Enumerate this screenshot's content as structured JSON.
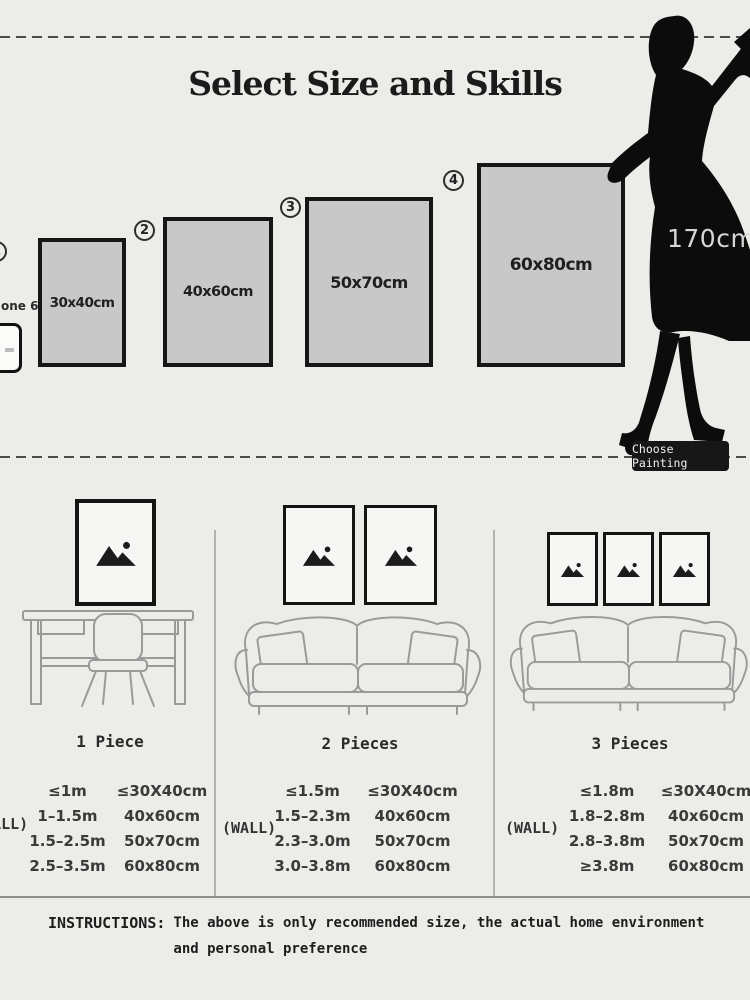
{
  "title": "Select Size and Skills",
  "sizes": {
    "items": [
      {
        "num": "1",
        "label": "30x40cm"
      },
      {
        "num": "2",
        "label": "40x60cm"
      },
      {
        "num": "3",
        "label": "50x70cm"
      },
      {
        "num": "4",
        "label": "60x80cm"
      }
    ],
    "phone_label": "one 6",
    "height_label": "170cm",
    "choose_button": "Choose Painting"
  },
  "scenes": [
    {
      "label": "1 Piece"
    },
    {
      "label": "2 Pieces"
    },
    {
      "label": "3 Pieces"
    }
  ],
  "tables": [
    {
      "wall_label": "(WALL)",
      "rows": [
        [
          "≤1m",
          "≤30X40cm"
        ],
        [
          "1–1.5m",
          "40x60cm"
        ],
        [
          "1.5–2.5m",
          "50x70cm"
        ],
        [
          "2.5–3.5m",
          "60x80cm"
        ]
      ]
    },
    {
      "wall_label": "(WALL)",
      "rows": [
        [
          "≤1.5m",
          "≤30X40cm"
        ],
        [
          "1.5–2.3m",
          "40x60cm"
        ],
        [
          "2.3–3.0m",
          "50x70cm"
        ],
        [
          "3.0–3.8m",
          "60x80cm"
        ]
      ]
    },
    {
      "wall_label": "(WALL)",
      "rows": [
        [
          "≤1.8m",
          "≤30X40cm"
        ],
        [
          "1.8–2.8m",
          "40x60cm"
        ],
        [
          "2.8–3.8m",
          "50x70cm"
        ],
        [
          "≥3.8m",
          "60x80cm"
        ]
      ]
    }
  ],
  "instructions": {
    "label": "INSTRUCTIONS:",
    "text": "The above is only recommended size, the actual home environment and personal preference"
  },
  "icons": {
    "image_placeholder": "mountains-with-sun",
    "woman_silhouette": "standing-woman-170cm"
  },
  "colors": {
    "background": "#ECECE9",
    "rect_fill": "#C8C8C8",
    "line_dark": "#161616",
    "badge_bg": "#171717"
  }
}
